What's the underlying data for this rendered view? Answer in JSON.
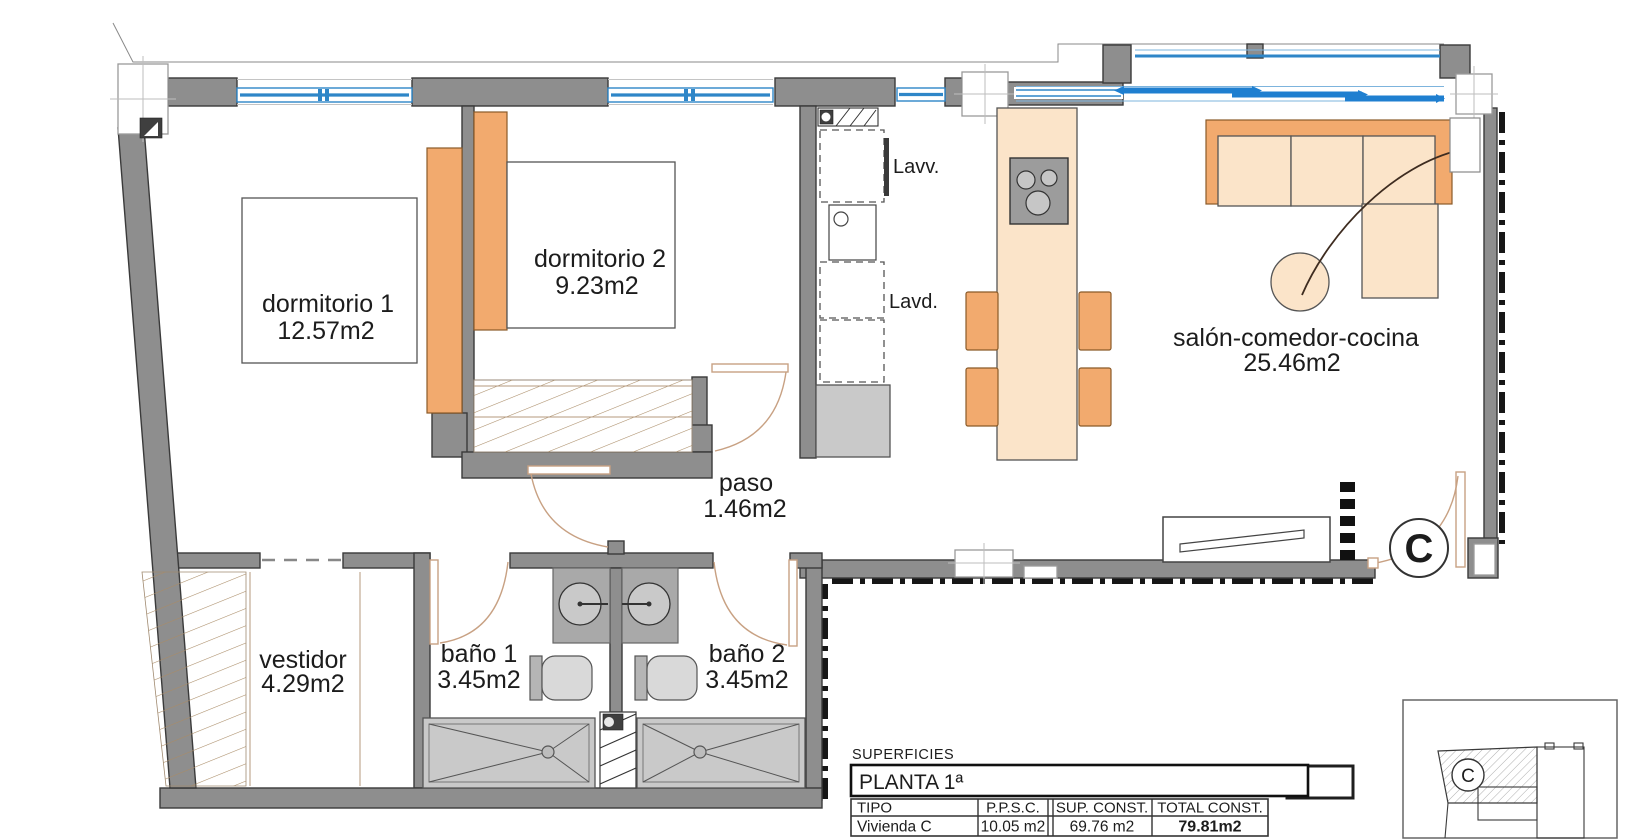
{
  "plan": {
    "unit_marker": "C",
    "rooms": [
      {
        "name": "dormitorio 1",
        "area": "12.57m2"
      },
      {
        "name": "dormitorio 2",
        "area": "9.23m2"
      },
      {
        "name": "salón-comedor-cocina",
        "area": "25.46m2"
      },
      {
        "name": "paso",
        "area": "1.46m2"
      },
      {
        "name": "vestidor",
        "area": "4.29m2"
      },
      {
        "name": "baño 1",
        "area": "3.45m2"
      },
      {
        "name": "baño 2",
        "area": "3.45m2"
      }
    ],
    "appliance_labels": {
      "dishwasher": "Lavv.",
      "washing_machine": "Lavd."
    }
  },
  "key_plan": {
    "unit_marker": "C"
  },
  "surface_table": {
    "section_title": "SUPERFICIES",
    "floor_title": "PLANTA 1ª",
    "columns": [
      "TIPO",
      "P.P.S.C.",
      "SUP. CONST.",
      "TOTAL CONST."
    ],
    "row": {
      "tipo": "Vivienda C",
      "ppsc": "10.05 m2",
      "sup_const": "69.76 m2",
      "total_const": "79.81m2"
    }
  },
  "colors": {
    "wall": "#8e8e8e",
    "window_glass": "#2e86c8",
    "furniture_orange": "#f2aa6e",
    "furniture_peach": "#fbe4c9",
    "boundary": "#161616",
    "hatch": "#a98b66"
  }
}
